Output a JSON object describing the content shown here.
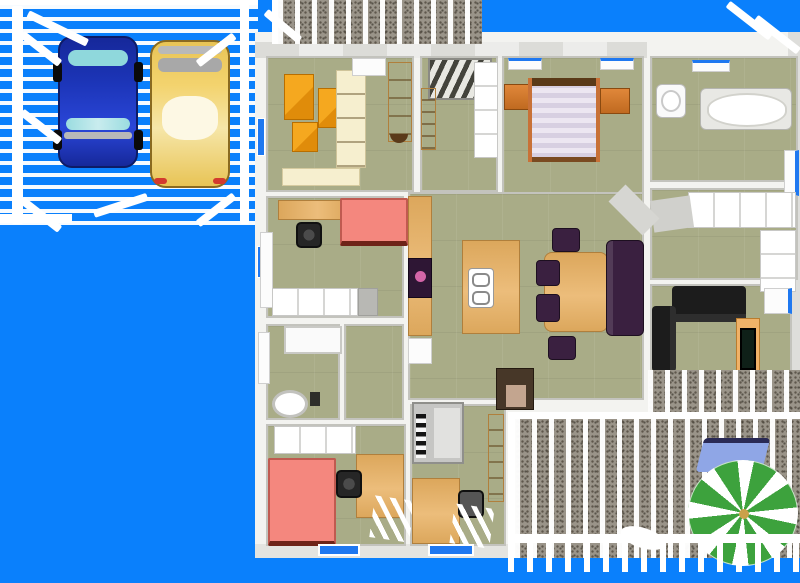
{
  "app": {
    "name": "home-3d-floor-plan-render",
    "view": "aerial top-down 3D view",
    "visible_text": "none"
  },
  "palette": {
    "sky": "#0a80fc",
    "floor_olive": "#a9ac87",
    "deck_gray": "#9a9489",
    "wood": "#dca75c",
    "cream": "#f6efcf",
    "orange": "#f5a81f",
    "orange_dark": "#e08c0a",
    "salmon": "#f4877e",
    "bed_trim": "#c87137",
    "purple_dark": "#3a2040",
    "window_blue": "#1f78f0",
    "umbrella_green": "#3da23d",
    "car_blue": "#1c35b8",
    "car_glass": "#8fd8dc",
    "car_yellow": "#f3d36e",
    "lounge_blue": "#8fa6e6",
    "sofa_black": "#1c1c1c"
  },
  "regions": {
    "carport": {
      "label": "open carport with slatted pergola roof",
      "vehicles": [
        "blue sedan",
        "yellow sedan"
      ]
    },
    "top_deck": {
      "label": "narrow slatted deck strip above house"
    },
    "rooms": [
      {
        "id": "craft-room",
        "contents": [
          "orange cabinets",
          "cream wardrobe",
          "wooden dresser",
          "cream shelf"
        ]
      },
      {
        "id": "entry-hall",
        "contents": [
          "staircase",
          "wooden shelf",
          "closet cells"
        ]
      },
      {
        "id": "master-bedroom",
        "contents": [
          "double bed with striped spread",
          "two nightstands",
          "two windows"
        ]
      },
      {
        "id": "bathroom",
        "contents": [
          "toilet",
          "bathtub",
          "window"
        ]
      },
      {
        "id": "walk-in-closet",
        "contents": [
          "white shelf units"
        ]
      },
      {
        "id": "bedroom-2",
        "contents": [
          "salmon bed",
          "wooden desk",
          "office chair",
          "closet row"
        ]
      },
      {
        "id": "great-room",
        "contents": [
          "kitchen counter with cooktop",
          "island with double sink",
          "dining table",
          "four purple chairs",
          "purple bench sofa",
          "wood stove"
        ]
      },
      {
        "id": "living-room",
        "contents": [
          "black sofa long",
          "black sofa short",
          "TV stand with television",
          "two windows"
        ]
      },
      {
        "id": "bathroom-2",
        "contents": [
          "shower tub",
          "round toilet"
        ]
      },
      {
        "id": "bedroom-3",
        "contents": [
          "salmon bed",
          "wooden desk",
          "office chair",
          "closet row",
          "window"
        ]
      },
      {
        "id": "music-room",
        "contents": [
          "upright piano",
          "wooden desk",
          "chair",
          "wooden shelf",
          "window"
        ]
      }
    ],
    "patio_deck": {
      "label": "rear wooden deck",
      "contents": [
        "green pinwheel patio umbrella",
        "blue lounge chair",
        "white railing with balusters"
      ]
    }
  }
}
